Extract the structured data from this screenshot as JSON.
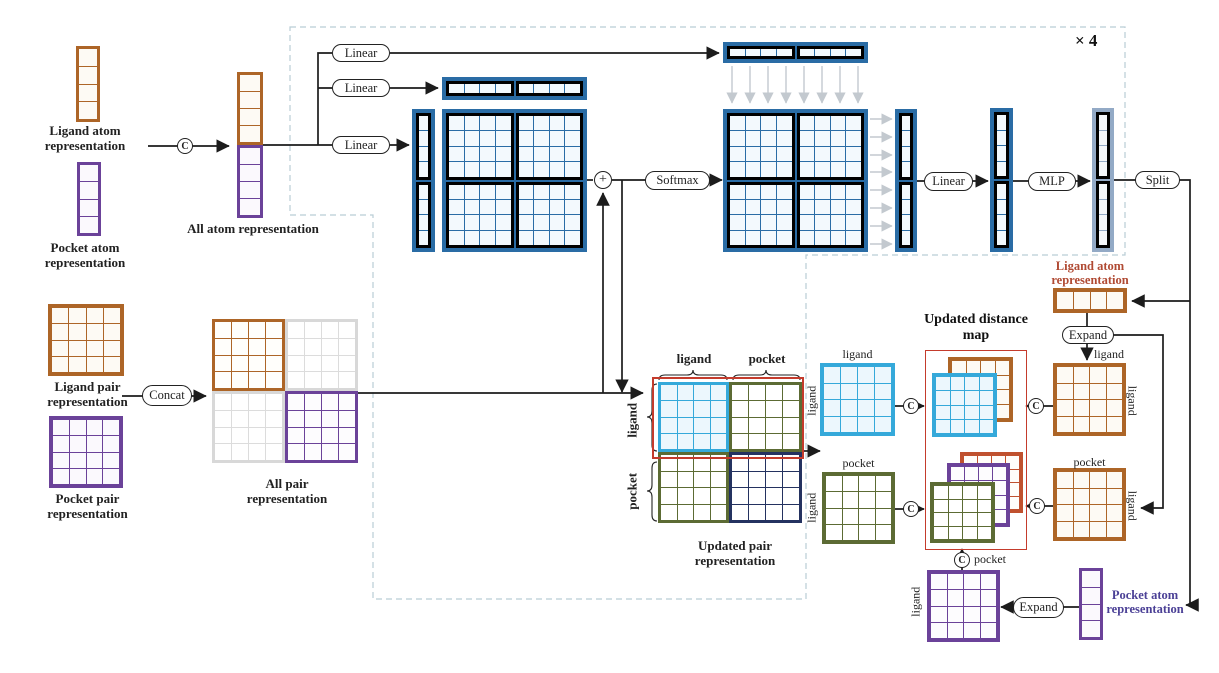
{
  "figure": {
    "multiplier": "× 4"
  },
  "symbols": {
    "concat": "C",
    "add": "+"
  },
  "colors": {
    "blue": "#2a6ca5",
    "light_blue_column": "#93aac6",
    "brown": "#ad6527",
    "brick_text": "#b04a33",
    "purple": "#6b4299",
    "purple_text": "#4b4096",
    "taupe_text": "#8a7060",
    "cyan": "#35a9da",
    "olive": "#5c6b34",
    "navy": "#243260",
    "vermillion": "#c0512e",
    "red_outline": "#c43b2c",
    "gray_grid": "#d8d8d8",
    "gray_text": "#8d929b",
    "dash_border": "#b9cdd5"
  },
  "left": {
    "ligand_atom_label": "Ligand atom representation",
    "pocket_atom_label": "Pocket atom representation",
    "all_atom_label": "All atom representation",
    "ligand_pair_label": "Ligand pair representation",
    "pocket_pair_label": "Pocket pair representation",
    "all_pair_label": "All pair representation",
    "concat": "Concat"
  },
  "attention": {
    "linear_q": "Linear",
    "linear_k": "Linear",
    "linear_v": "Linear",
    "softmax": "Softmax",
    "linear_out": "Linear",
    "mlp": "MLP",
    "split": "Split"
  },
  "updated_pair": {
    "caption": "Updated pair representation",
    "ligand": "ligand",
    "pocket": "pocket"
  },
  "split_maps": {
    "ligand": "ligand",
    "pocket": "pocket"
  },
  "distance_map": {
    "title": "Updated distance map",
    "pocket": "pocket"
  },
  "right": {
    "ligand_atom_label": "Ligand atom representation",
    "expand_top": "Expand",
    "expand_bottom": "Expand",
    "pocket_atom_label": "Pocket atom representation",
    "ligand": "ligand",
    "pocket": "pocket"
  }
}
